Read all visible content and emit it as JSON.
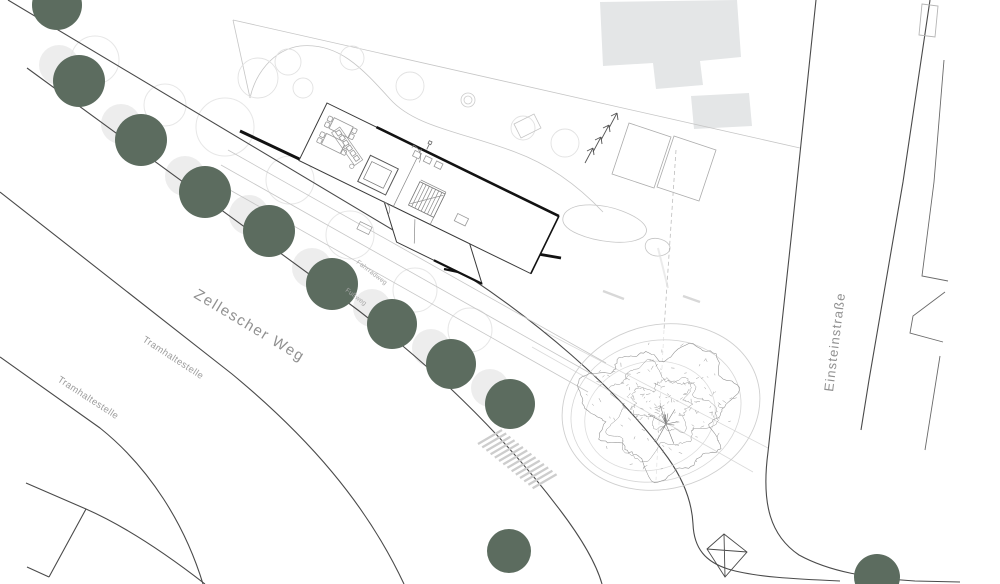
{
  "page": {
    "type": "architectural site plan (Lageplan)"
  },
  "labels": {
    "street_main": "Zellescher Weg",
    "street_side": "Einsteinstraße",
    "tram_stop_1": "Tramhaltestelle",
    "tram_stop_2": "Tramhaltestelle",
    "path_bike": "Fahrradweg",
    "path_foot": "Fußweg"
  },
  "colors": {
    "tree_fill": "#5c6c5f",
    "tree_shadow": "#ededed",
    "canopy_ring": "#e7e7e7",
    "building_mass": "#e4e6e7",
    "road_line": "#4a4a4a",
    "wall_black": "#121212",
    "light_line": "#c6c6c6",
    "label_gray": "#909090",
    "background": "#ffffff"
  },
  "site": {
    "street_trees": [
      {
        "cx": 57,
        "cy": 5,
        "r": 25
      },
      {
        "cx": 79,
        "cy": 81,
        "r": 26
      },
      {
        "cx": 141,
        "cy": 140,
        "r": 26
      },
      {
        "cx": 205,
        "cy": 192,
        "r": 26
      },
      {
        "cx": 269,
        "cy": 231,
        "r": 26
      },
      {
        "cx": 332,
        "cy": 284,
        "r": 26
      },
      {
        "cx": 392,
        "cy": 324,
        "r": 25
      },
      {
        "cx": 451,
        "cy": 364,
        "r": 25
      },
      {
        "cx": 510,
        "cy": 404,
        "r": 25
      },
      {
        "cx": 509,
        "cy": 551,
        "r": 22
      },
      {
        "cx": 877,
        "cy": 577,
        "r": 23
      }
    ],
    "canopy_rings": [
      {
        "cx": 95,
        "cy": 60,
        "r": 24
      },
      {
        "cx": 165,
        "cy": 105,
        "r": 21
      },
      {
        "cx": 225,
        "cy": 127,
        "r": 29
      },
      {
        "cx": 290,
        "cy": 180,
        "r": 24
      },
      {
        "cx": 350,
        "cy": 235,
        "r": 24
      },
      {
        "cx": 415,
        "cy": 290,
        "r": 22
      },
      {
        "cx": 470,
        "cy": 330,
        "r": 22
      }
    ],
    "large_tree": {
      "cx": 661,
      "cy": 407,
      "rx": 100,
      "ry": 82
    }
  }
}
